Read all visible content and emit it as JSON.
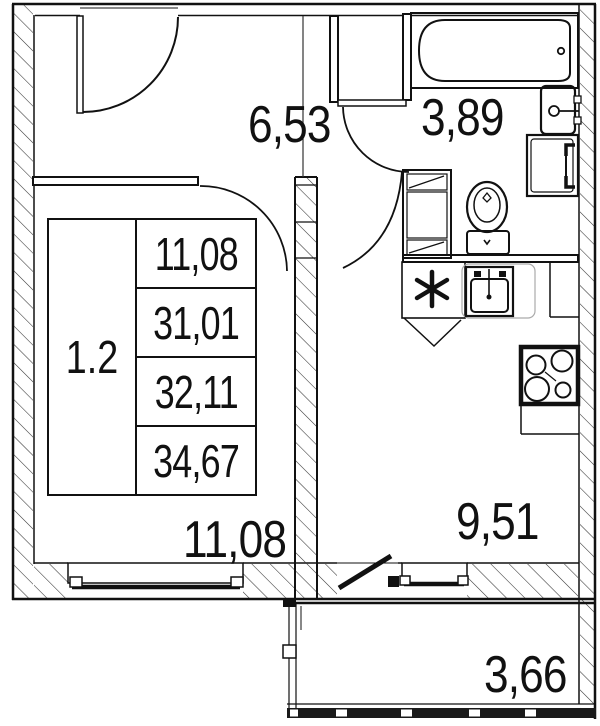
{
  "plan": {
    "type": "apartment-floor-plan",
    "unit": {
      "number": "1.2"
    },
    "stamp_rows": [
      {
        "value": "11,08"
      },
      {
        "value": "31,01"
      },
      {
        "value": "32,11"
      },
      {
        "value": "34,67"
      }
    ],
    "rooms": [
      {
        "name": "hallway",
        "area": "6,53"
      },
      {
        "name": "bathroom",
        "area": "3,89"
      },
      {
        "name": "living-room",
        "area": "11,08"
      },
      {
        "name": "kitchen",
        "area": "9,51"
      },
      {
        "name": "balcony",
        "area": "3,66"
      }
    ],
    "fixtures": [
      "bathtub",
      "bathroom-sink",
      "washing-machine",
      "toilet",
      "bathroom-cabinet",
      "stove-symbol",
      "kitchen-sink",
      "hob-4-burners",
      "kitchen-counter",
      "entrance-door",
      "bathroom-door",
      "living-room-door",
      "kitchen-door",
      "living-room-window",
      "kitchen-window",
      "balcony-door",
      "balcony-railing"
    ],
    "colors": {
      "line": "#111111",
      "background": "#ffffff"
    }
  }
}
